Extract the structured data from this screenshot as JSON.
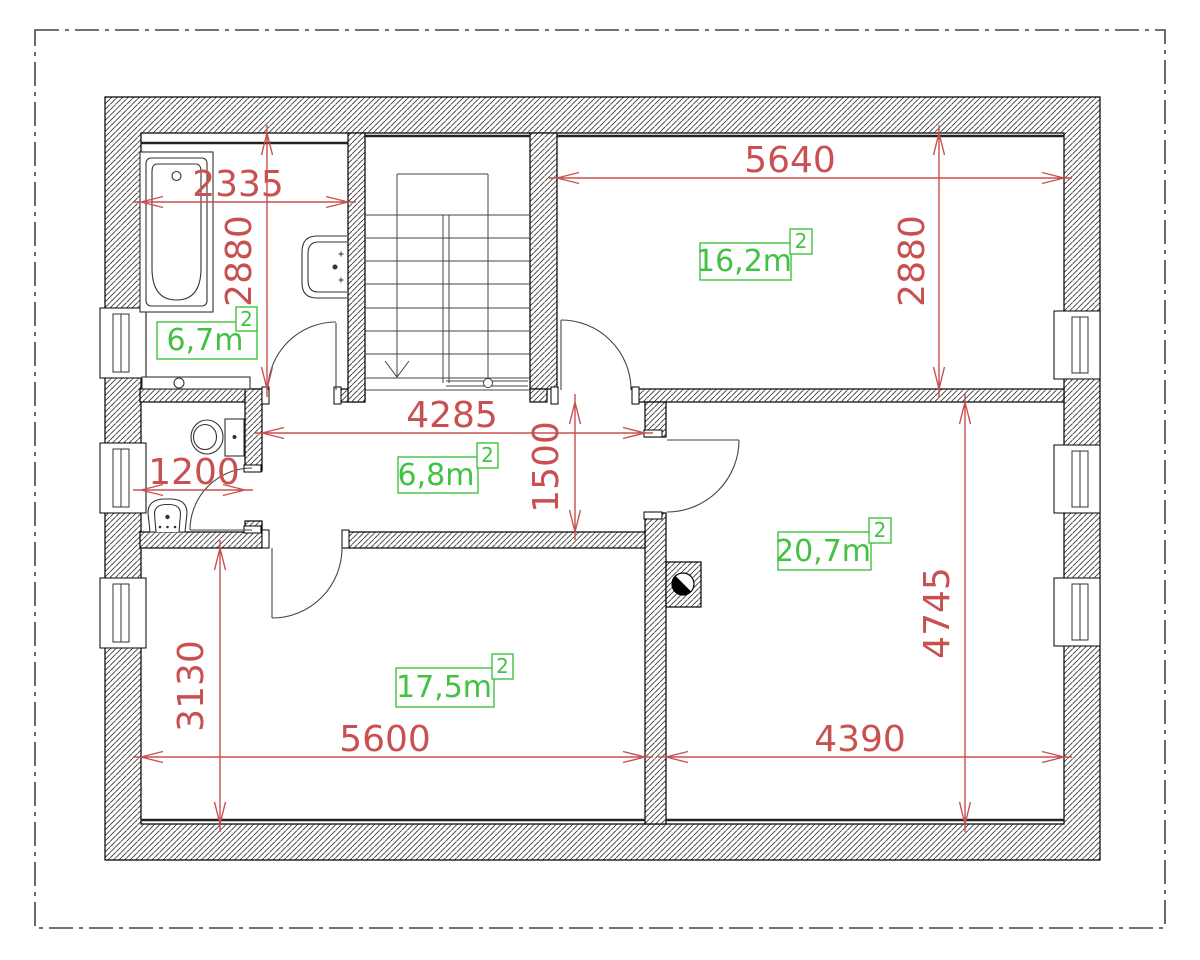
{
  "plan": {
    "kind": "floor-plan",
    "colors": {
      "dimension_red": "#c85050",
      "area_green": "#42c142"
    },
    "rooms": {
      "bathroom": {
        "area": "6,7m",
        "area_sup": "2"
      },
      "bedroom_top_right": {
        "area": "16,2m",
        "area_sup": "2"
      },
      "hallway": {
        "area": "6,8m",
        "area_sup": "2"
      },
      "room_bottom_left": {
        "area": "17,5m",
        "area_sup": "2"
      },
      "room_bottom_right": {
        "area": "20,7m",
        "area_sup": "2"
      }
    },
    "dimensions": {
      "bathroom_width": "2335",
      "bathroom_height": "2880",
      "top_right_width": "5640",
      "top_right_height": "2880",
      "hallway_width": "4285",
      "hallway_height": "1500",
      "wc_width": "1200",
      "bottom_left_height": "3130",
      "bottom_left_width": "5600",
      "bottom_right_width": "4390",
      "bottom_right_height": "4745"
    }
  }
}
